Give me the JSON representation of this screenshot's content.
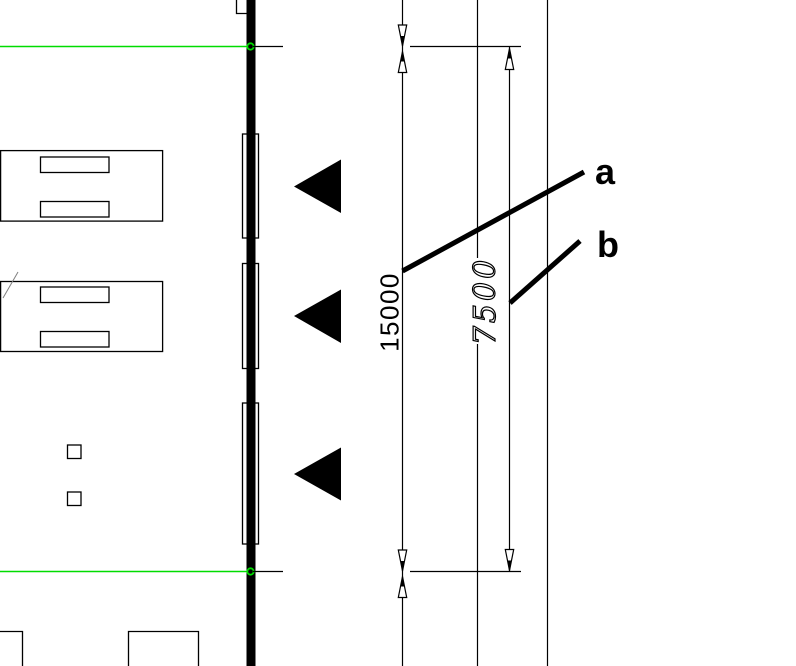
{
  "drawing": {
    "annotations": [
      {
        "label": "a"
      },
      {
        "label": "b"
      }
    ],
    "dimensions": [
      {
        "value": "15000"
      },
      {
        "value": "7500"
      }
    ],
    "colors": {
      "ink": "#000000",
      "grid_green": "#00dc00",
      "background": "#ffffff"
    },
    "icons": {
      "entrance_marker": "left-pointing-filled-triangle",
      "dimension_arrow": "open-dimension-arrowhead",
      "grid_point": "green-circle-marker"
    }
  }
}
